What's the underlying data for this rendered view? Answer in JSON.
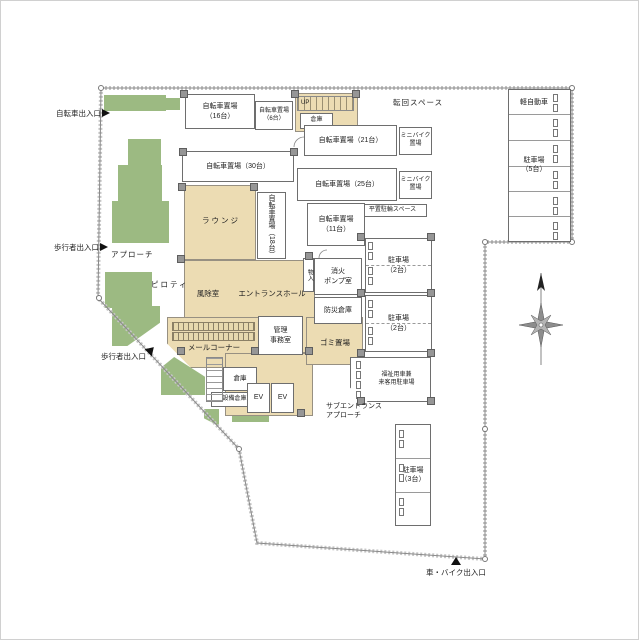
{
  "colors": {
    "landscape_green": "#9cba82",
    "room_beige": "#ecdcb3",
    "wall_gray": "#969696",
    "boundary_gray": "#8a8a8a"
  },
  "labels": {
    "bicycle_entrance": "自転車出入口",
    "pedestrian_entrance_west": "歩行者出入口",
    "pedestrian_exit_south": "歩行者出入口",
    "car_bike_entrance": "車・バイク出入口",
    "approach": "アプローチ",
    "piloti": "ピロティ",
    "turning_space": "転回スペース",
    "sub_entrance_approach": "サブエントランス\nアプローチ",
    "lounge": "ラウンジ",
    "windbreak_room": "風除室",
    "entrance_hall": "エントランスホール",
    "mail_corner": "メールコーナー",
    "admin_office": "管理\n事務室",
    "fire_pump_room": "消火\nポンプ室",
    "disaster_storage": "防災倉庫",
    "garbage_area": "ゴミ置場",
    "closet": "物入",
    "storage_top": "倉庫",
    "storage_small": "倉庫",
    "equipment_storage": "設備倉庫",
    "elevator_1": "EV",
    "elevator_2": "EV",
    "stairs_up": "UP",
    "bike_16": "自転車置場\n（16台）",
    "bike_6": "自転車置場\n（6台）",
    "bike_30": "自転車置場（30台）",
    "bike_21": "自転車置場（21台）",
    "bike_25": "自転車置場（25台）",
    "bike_18": "自転車置場（18台）",
    "bike_11": "自転車置場\n（11台）",
    "minibike_upper": "ミニバイク\n置場",
    "minibike_lower": "ミニバイク\n置場",
    "flat_bike_space": "平置駐輪スペース",
    "parking_2_upper": "駐車場\n（2台）",
    "parking_2_lower": "駐車場\n（2台）",
    "parking_3": "駐車場\n（3台）",
    "parking_5": "駐車場\n（5台）",
    "kei_car": "軽自動車",
    "welfare_visitor_parking": "福祉用車兼\n来客用駐車場"
  }
}
